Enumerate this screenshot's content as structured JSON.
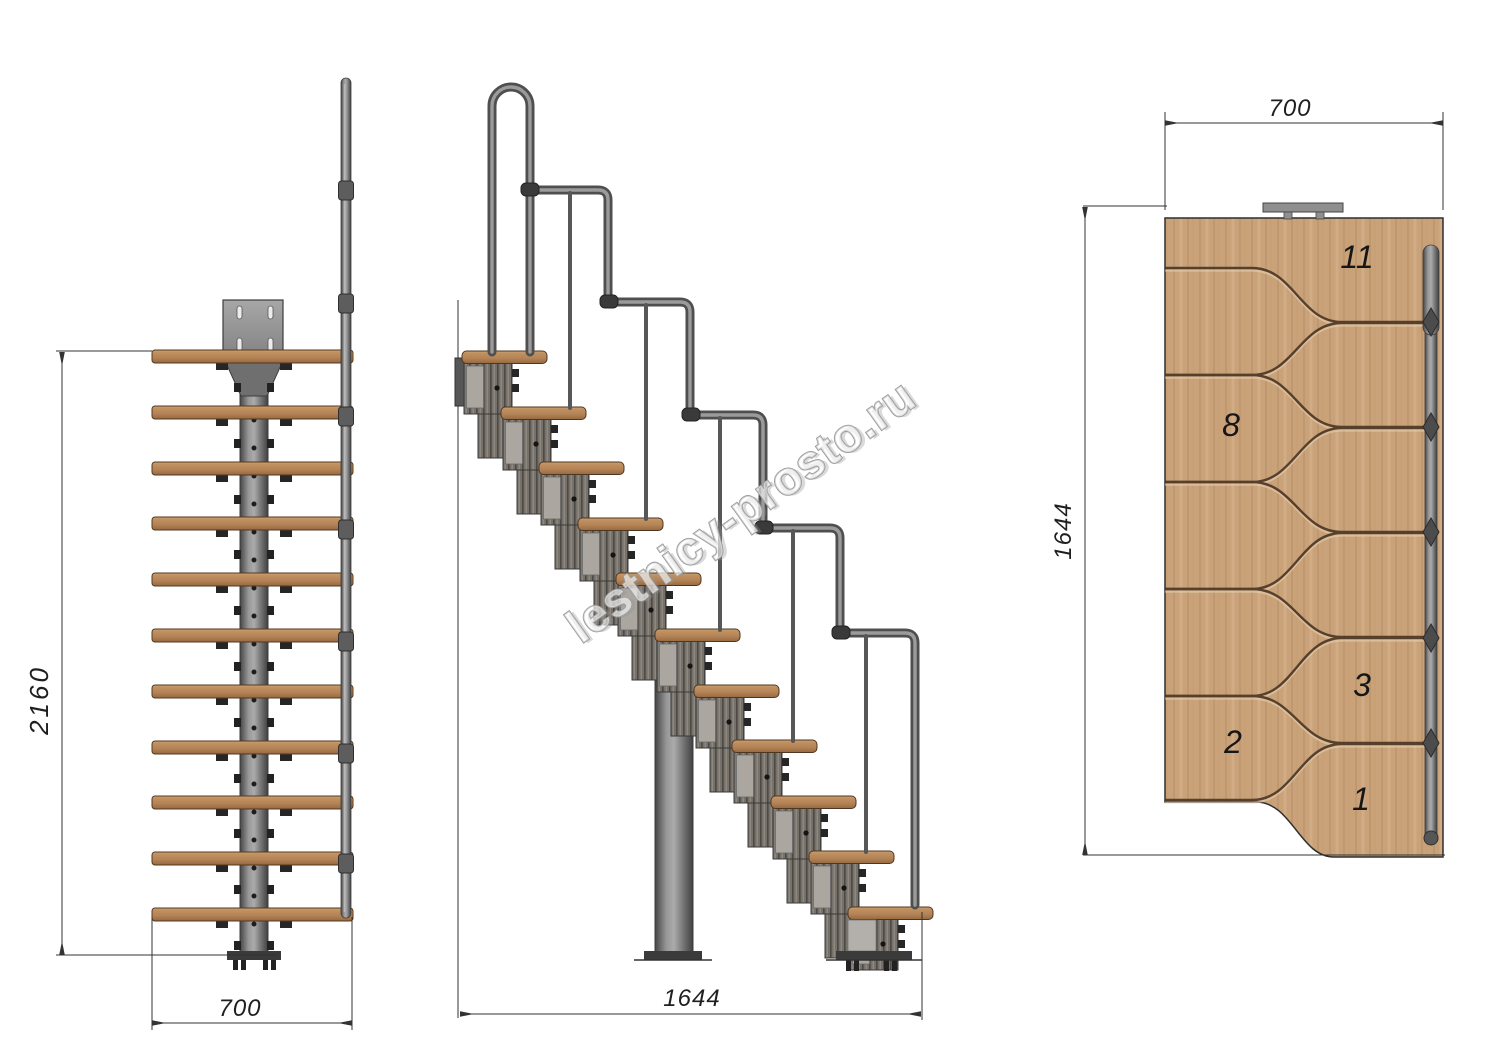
{
  "watermark": {
    "text": "lestnicy-prosto.ru"
  },
  "front_view": {
    "height_label": "2160",
    "width_label": "700"
  },
  "side_view": {
    "length_label": "1644"
  },
  "plan_view": {
    "width_label": "700",
    "length_label": "1644",
    "steps": [
      "11",
      "8",
      "3",
      "2",
      "1"
    ]
  }
}
